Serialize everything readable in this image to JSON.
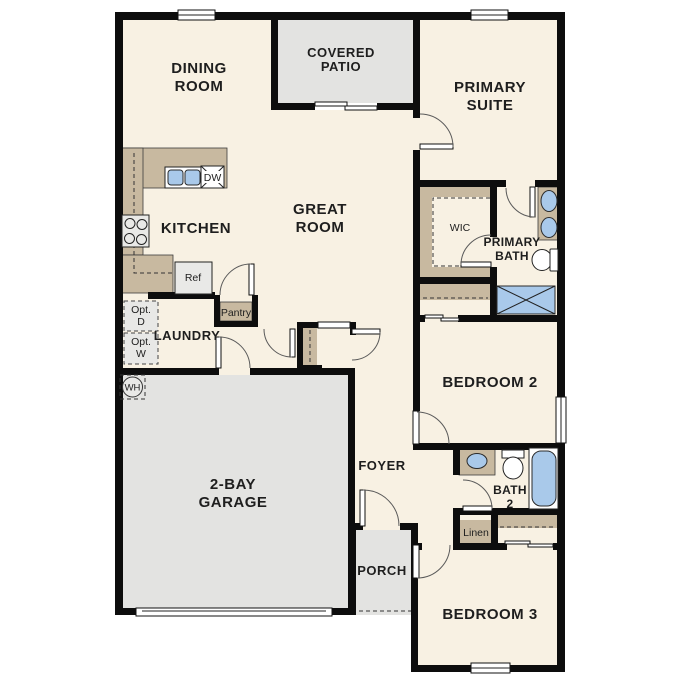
{
  "colors": {
    "background": "#ffffff",
    "floor": "#f8f1e3",
    "hard_surface": "#e3e3e1",
    "counter": "#c8b9a0",
    "fixture_blue": "#a9c9ea",
    "wall": "#0d0d0d",
    "text": "#1e1e1e"
  },
  "rooms": {
    "dining": [
      "DINING",
      "ROOM"
    ],
    "covered_patio": [
      "COVERED",
      "PATIO"
    ],
    "primary_suite": [
      "PRIMARY",
      "SUITE"
    ],
    "great_room": [
      "GREAT",
      "ROOM"
    ],
    "kitchen": "KITCHEN",
    "wic": "WIC",
    "primary_bath": [
      "PRIMARY",
      "BATH"
    ],
    "laundry": "LAUNDRY",
    "bedroom_2": "BEDROOM 2",
    "foyer": "FOYER",
    "bath_2": [
      "BATH",
      "2"
    ],
    "garage": [
      "2-BAY",
      "GARAGE"
    ],
    "porch": "PORCH",
    "bedroom_3": "BEDROOM 3"
  },
  "labels": {
    "dishwasher": "DW",
    "refrigerator": "Ref",
    "pantry": "Pantry",
    "optional_dryer": [
      "Opt.",
      "D"
    ],
    "optional_washer": [
      "Opt.",
      "W"
    ],
    "water_heater": "WH",
    "linen": "Linen"
  }
}
